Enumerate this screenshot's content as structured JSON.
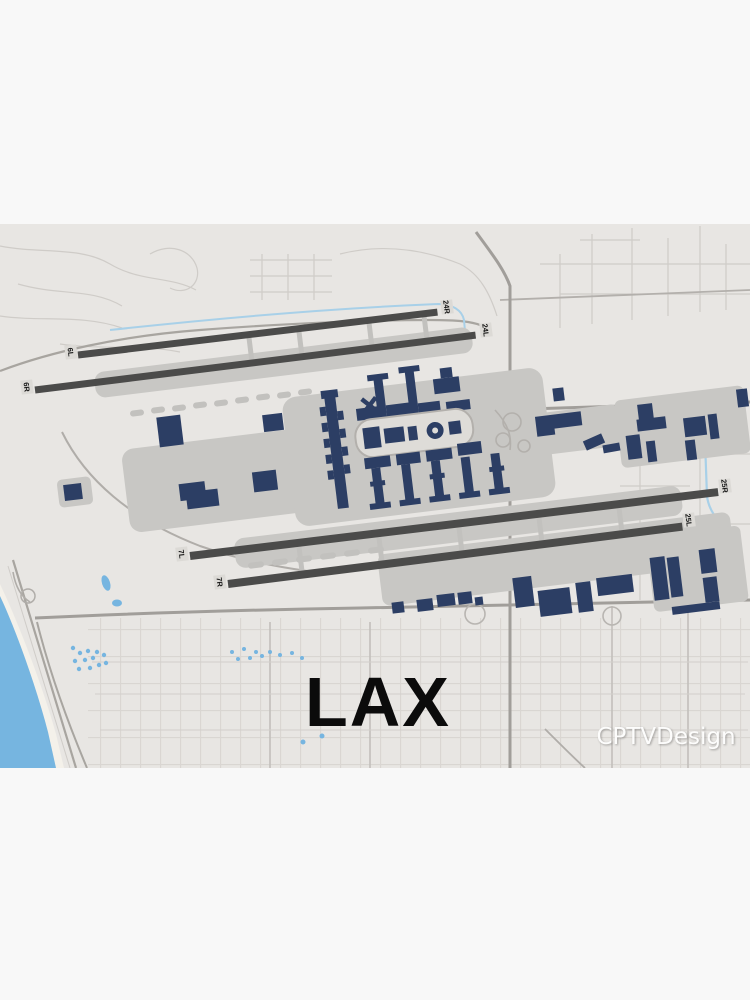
{
  "poster": {
    "title": "LAX",
    "watermark": "CPTVDesign"
  },
  "map": {
    "airport_code": "LAX",
    "runways": [
      {
        "name": "6L/24R",
        "left_label": "6L",
        "right_label": "24R"
      },
      {
        "name": "6R/24L",
        "left_label": "6R",
        "right_label": "24L"
      },
      {
        "name": "7L/25R",
        "left_label": "7L",
        "right_label": "25R"
      },
      {
        "name": "7R/25L",
        "left_label": "7R",
        "right_label": "25L"
      }
    ],
    "colors": {
      "margin_band": "#f8f8f8",
      "land": "#e8e6e3",
      "water": "#76b5e0",
      "channel": "#a8d0e8",
      "runway": "#4b4b4a",
      "building": "#2c3e64",
      "apron": "#c8c7c4",
      "major_road": "#a8a5a0",
      "minor_road": "#cfccc8",
      "title_color": "#0b0b0b"
    }
  }
}
